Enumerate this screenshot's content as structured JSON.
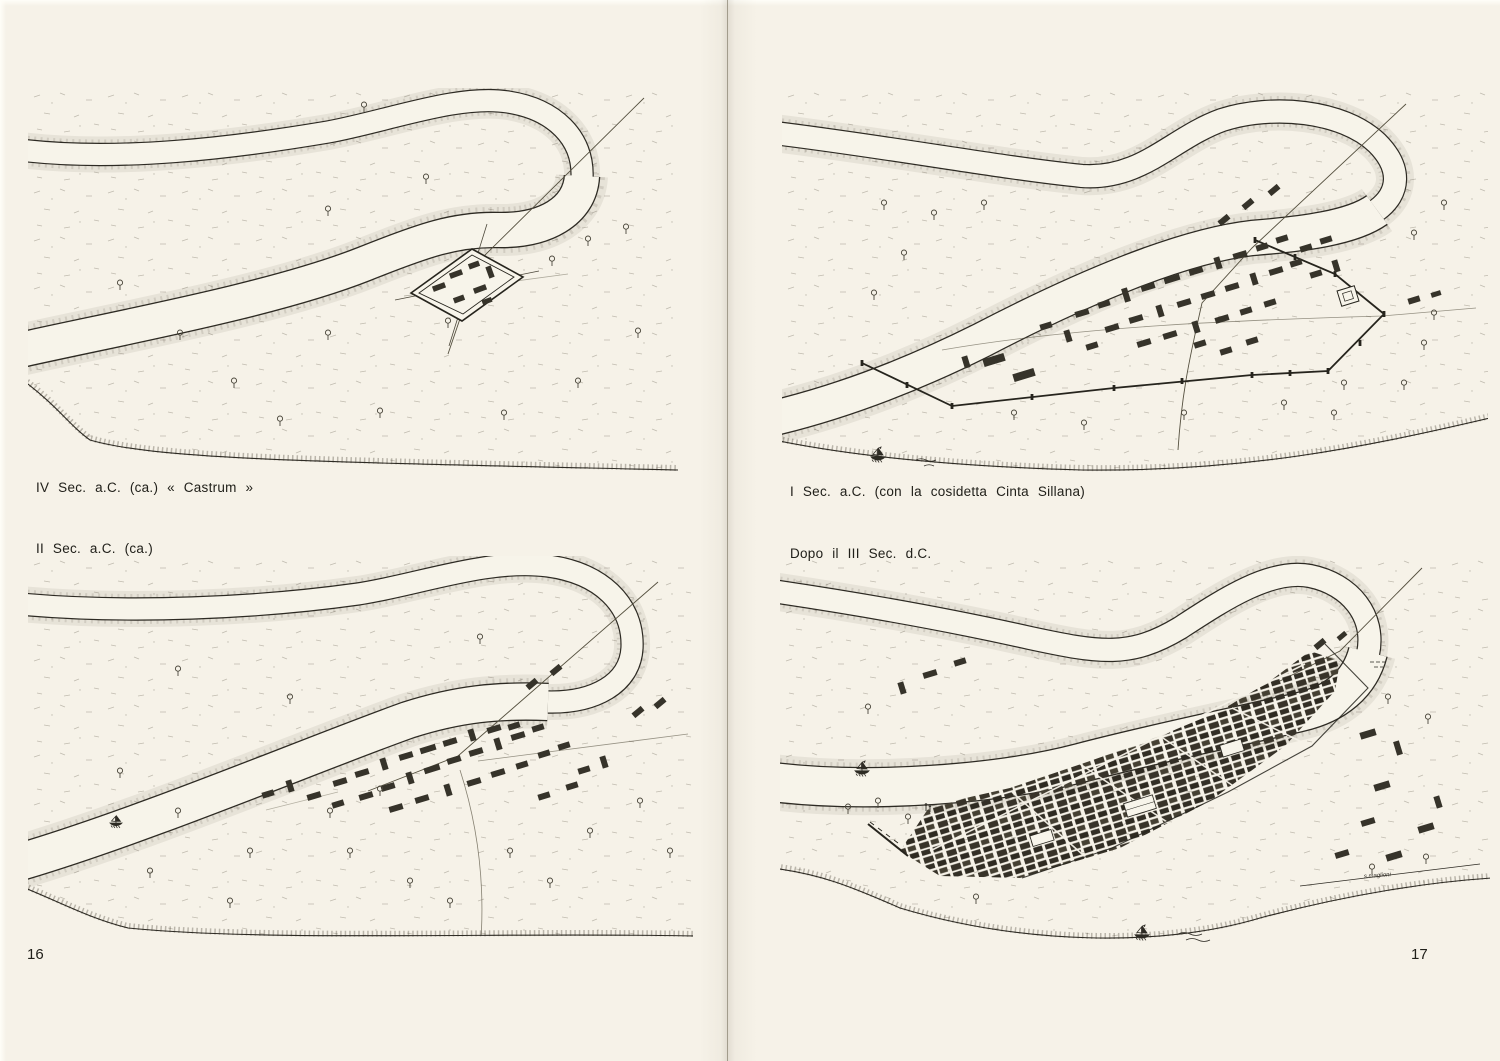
{
  "page": {
    "paper_color": "#f6f2e8",
    "ink_color": "#2d2a23",
    "left_page_number": "16",
    "right_page_number": "17"
  },
  "panels": [
    {
      "id": "castrum",
      "caption": "IV Sec. a.C. (ca.) « Castrum »"
    },
    {
      "id": "ii-sec-ac",
      "caption": "II Sec. a.C. (ca.)"
    },
    {
      "id": "i-sec-ac",
      "caption": "I Sec. a.C. (con la cosidetta Cinta Sillana)"
    },
    {
      "id": "dopo-iii-sec",
      "caption": "Dopo il III Sec. d.C."
    }
  ],
  "signature": "s.maglioni"
}
